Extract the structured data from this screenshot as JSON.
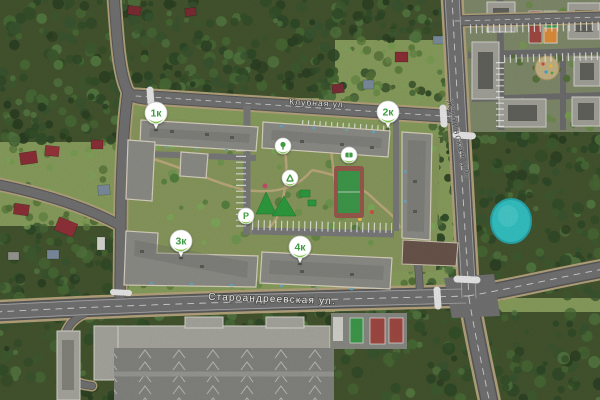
{
  "map": {
    "streets": {
      "klubnaya": "Клубная ул.",
      "staroandreevskaya": "Староандреевская ул.",
      "zhilinskaya": "Жилинская ул."
    },
    "building_markers": [
      {
        "id": "1k",
        "label": "1к"
      },
      {
        "id": "2k",
        "label": "2к"
      },
      {
        "id": "3k",
        "label": "3к"
      },
      {
        "id": "4k",
        "label": "4к"
      }
    ],
    "parking_marker": {
      "label": "P"
    },
    "amenity_markers": [
      {
        "id": "kindergarten",
        "icon": "tree-icon"
      },
      {
        "id": "playground",
        "icon": "slide-icon"
      },
      {
        "id": "sports-field",
        "icon": "field-icon"
      }
    ],
    "colors": {
      "marker_green": "#3f9c43",
      "marker_leaf": "#7cc242",
      "pond": "#35c5c6",
      "court_red": "#a34a44",
      "court_green": "#3f9c4c",
      "court_orange": "#e0903c",
      "road": "#717171",
      "forest": "#45562f"
    }
  }
}
